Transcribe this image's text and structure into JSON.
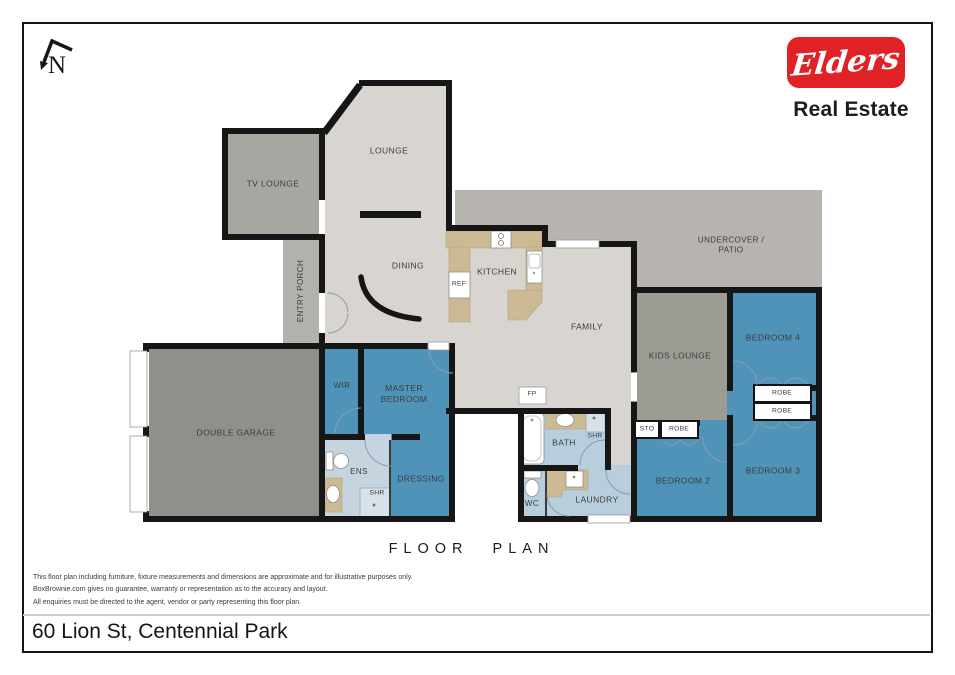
{
  "brand": {
    "logo_text": "Elders",
    "tagline": "Real Estate",
    "logo_color": "#e02125"
  },
  "compass": {
    "label": "N"
  },
  "footer": {
    "title": "FLOOR PLAN",
    "address": "60 Lion St, Centennial Park",
    "disclaimer": {
      "line1": "This floor plan including furniture, fixture measurements and dimensions are approximate and for illustrative purposes only.",
      "line2": "BoxBrownie.com gives no guarantee, warranty or representation as to the accuracy and layout.",
      "line3": "All enquiries must be directed to the agent, vendor or party representing this floor plan."
    }
  },
  "rooms": {
    "tv_lounge": "TV LOUNGE",
    "lounge": "LOUNGE",
    "entry_porch": "ENTRY PORCH",
    "dining": "DINING",
    "kitchen": "KITCHEN",
    "family": "FAMILY",
    "patio": "UNDERCOVER /\nPATIO",
    "double_garage": "DOUBLE GARAGE",
    "wir": "WIR",
    "master_bedroom": "MASTER\nBEDROOM",
    "ens": "ENS",
    "dressing": "DRESSING",
    "bath": "BATH",
    "wc": "WC",
    "laundry": "LAUNDRY",
    "kids_lounge": "KIDS LOUNGE",
    "bedroom_2": "BEDROOM 2",
    "bedroom_3": "BEDROOM 3",
    "bedroom_4": "BEDROOM 4"
  },
  "fixtures": {
    "ref": "REF",
    "fp": "FP",
    "shr_ens": "SHR",
    "shr_bath": "SHR",
    "sto": "STO",
    "robe_top": "ROBE",
    "robe_bottom": "ROBE",
    "robe_bed2": "ROBE"
  },
  "colors": {
    "brand_red": "#e02125",
    "bedroom_blue": "#4f93b8",
    "floor_beige": "#d8d4d0",
    "garage_gray": "#90908a",
    "patio_gray": "#b7b4af",
    "wet_area_blue": "#b8cedd",
    "bench_tan": "#ccba94",
    "wall_black": "#161616"
  }
}
